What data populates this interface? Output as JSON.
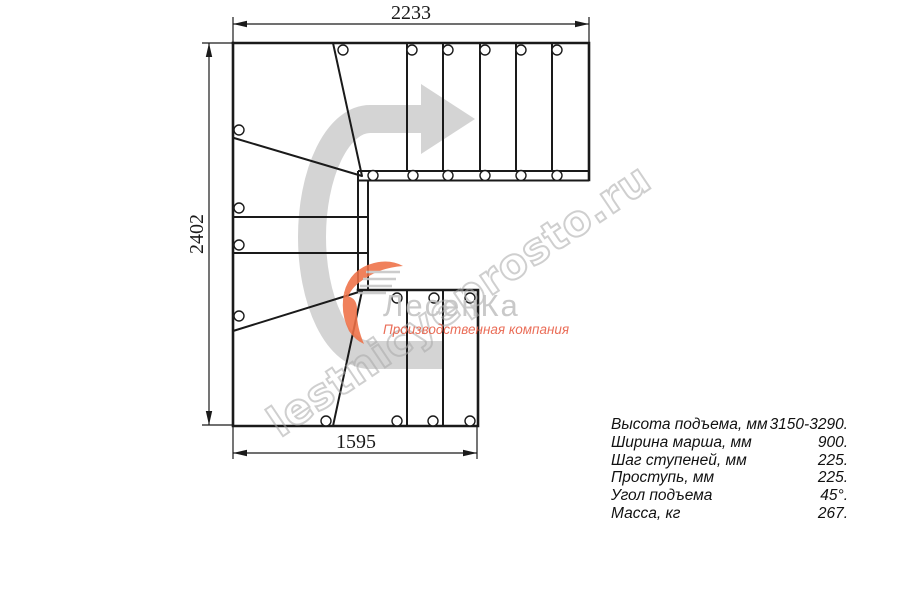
{
  "drawing": {
    "title": "stair-plan-top-view",
    "dimensions": {
      "top": "2233",
      "left": "2402",
      "bottom": "1595"
    }
  },
  "specs": {
    "rows": [
      {
        "label": "Высота подъема, мм",
        "value": "3150-3290."
      },
      {
        "label": "Ширина марша, мм",
        "value": "900."
      },
      {
        "label": "Шаг ступеней, мм",
        "value": "225."
      },
      {
        "label": "Проступь, мм",
        "value": "225."
      },
      {
        "label": "Угол подъема",
        "value": "45°."
      },
      {
        "label": "Масса, кг",
        "value": "267."
      }
    ]
  },
  "watermark": {
    "text": "lestnicyeprosto.ru"
  },
  "logo": {
    "name": "ЛесенКа",
    "subtitle": "Производственная компания"
  },
  "icons": {
    "direction_arrow": "curved-route-arrow-180-turn-pointing-right",
    "logo_icon": "orange-swoosh-with-gray-steps"
  },
  "colors": {
    "line": "#1a1a1a",
    "route_arrow_gray": "#d4d4d4",
    "logo_orange": "#ef7046",
    "logo_gray": "#c2c2c2",
    "logo_subtitle_red": "#e85a41",
    "watermark_gray": "#a9a9a9",
    "background": "#ffffff"
  }
}
